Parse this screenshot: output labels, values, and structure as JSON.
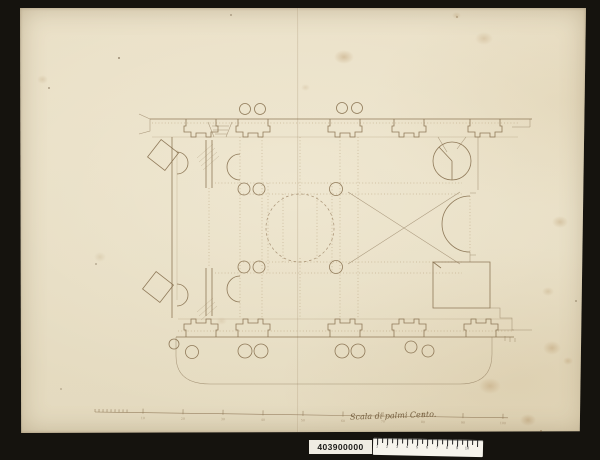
{
  "photo": {
    "background_color": "#15130e",
    "paper_color": "#eae0c7",
    "ink_color": "#856e4c"
  },
  "drawing": {
    "subject": "floor plan of a domed church, pen and ink on laid paper",
    "caption_handwritten": "Scala di palmi Cento.",
    "scale_bar_labels": [
      "10",
      "20",
      "30",
      "40",
      "50",
      "60",
      "70",
      "80",
      "90",
      "100"
    ]
  },
  "archive_strip": {
    "inventory_number": "403900000",
    "ruler_numbers": [
      "1",
      "2",
      "3",
      "4",
      "5",
      "6",
      "7",
      "8",
      "9",
      "10"
    ]
  }
}
